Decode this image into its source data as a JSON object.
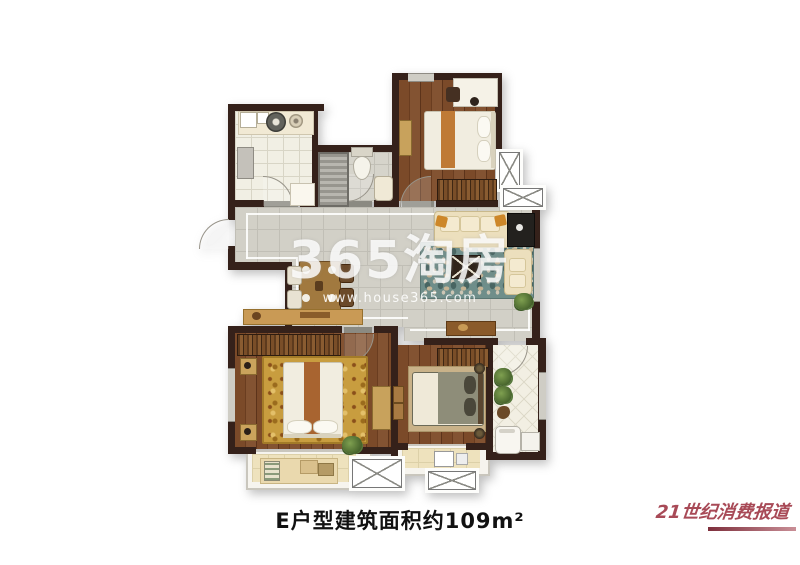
{
  "caption": {
    "text": "E户型建筑面积约109m²"
  },
  "watermark": {
    "brand": "365淘房",
    "url": "www.house365.com"
  },
  "publisher_logo": {
    "text": "21世纪消费报道"
  },
  "colors": {
    "wall": "#35211a",
    "wood_floor": "#7b4a29",
    "kitchen_tile": "#f1efe4",
    "bath_tile": "#d6d4cb",
    "living_tile": "#d2d0c7",
    "balcony_floor": "#eee2bd",
    "living_rug_teal": "#6f8e8a",
    "master_rug_gold": "#c89d3f",
    "sofa_cream": "#ecdfbd",
    "accent_orange": "#cd8729",
    "bed_runner": "#bf7a35",
    "logo_red": "#a84a57",
    "watermark_white": "rgba(255,255,255,0.82)"
  }
}
